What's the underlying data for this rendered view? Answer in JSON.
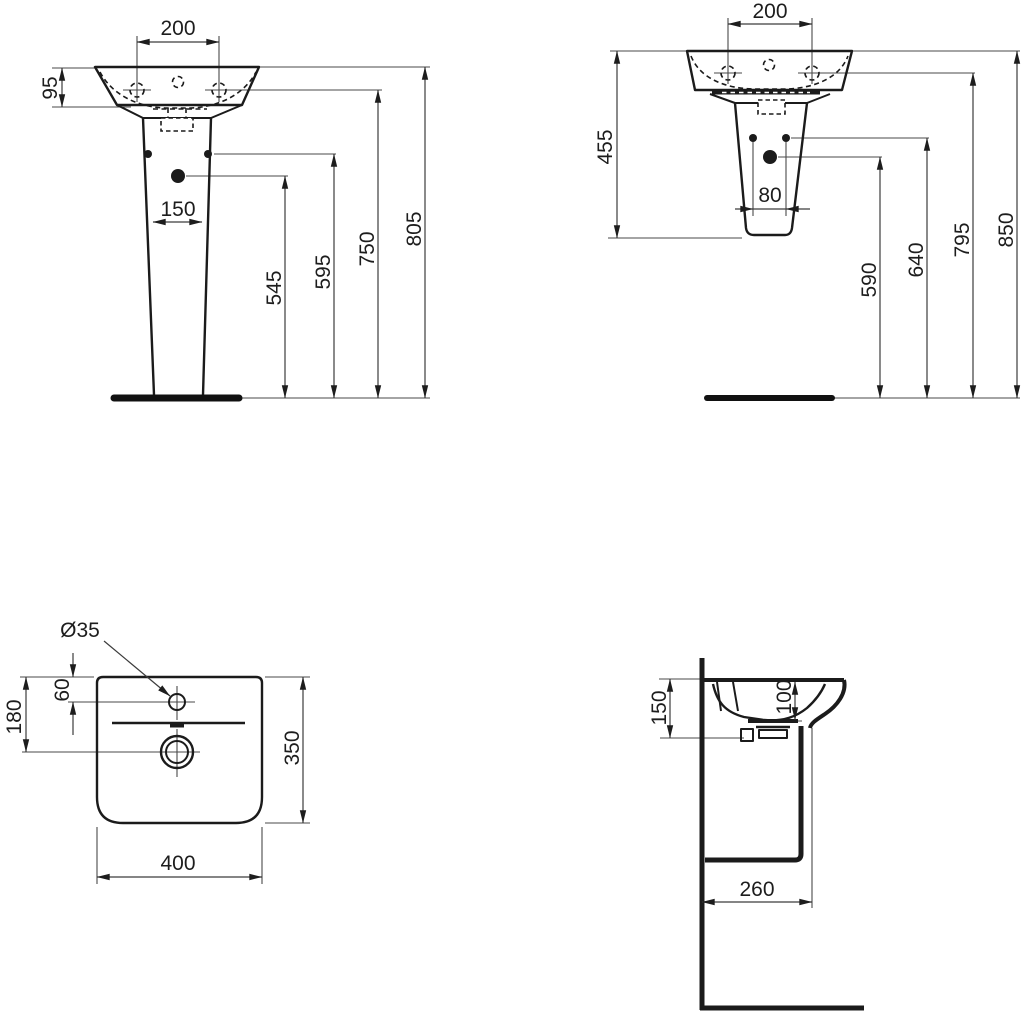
{
  "drawing": {
    "background": "#ffffff",
    "ink": "#1b1b1b",
    "front_view": {
      "tap_hole_spacing": "200",
      "rim_height": "95",
      "pedestal_width": "150",
      "height_545": "545",
      "height_595": "595",
      "height_750": "750",
      "height_805": "805"
    },
    "rear_view": {
      "tap_hole_spacing": "200",
      "basin_semipedestal_height": "455",
      "fixing_hole_spacing": "80",
      "height_590": "590",
      "height_640": "640",
      "height_795": "795",
      "height_850": "850"
    },
    "plan_view": {
      "tap_hole_diameter": "Ø35",
      "tap_hole_offset": "60",
      "drain_offset": "180",
      "depth": "350",
      "width": "400"
    },
    "section_view": {
      "rim_to_bottom": "150",
      "bowl_depth": "100",
      "wall_to_front": "260"
    }
  }
}
